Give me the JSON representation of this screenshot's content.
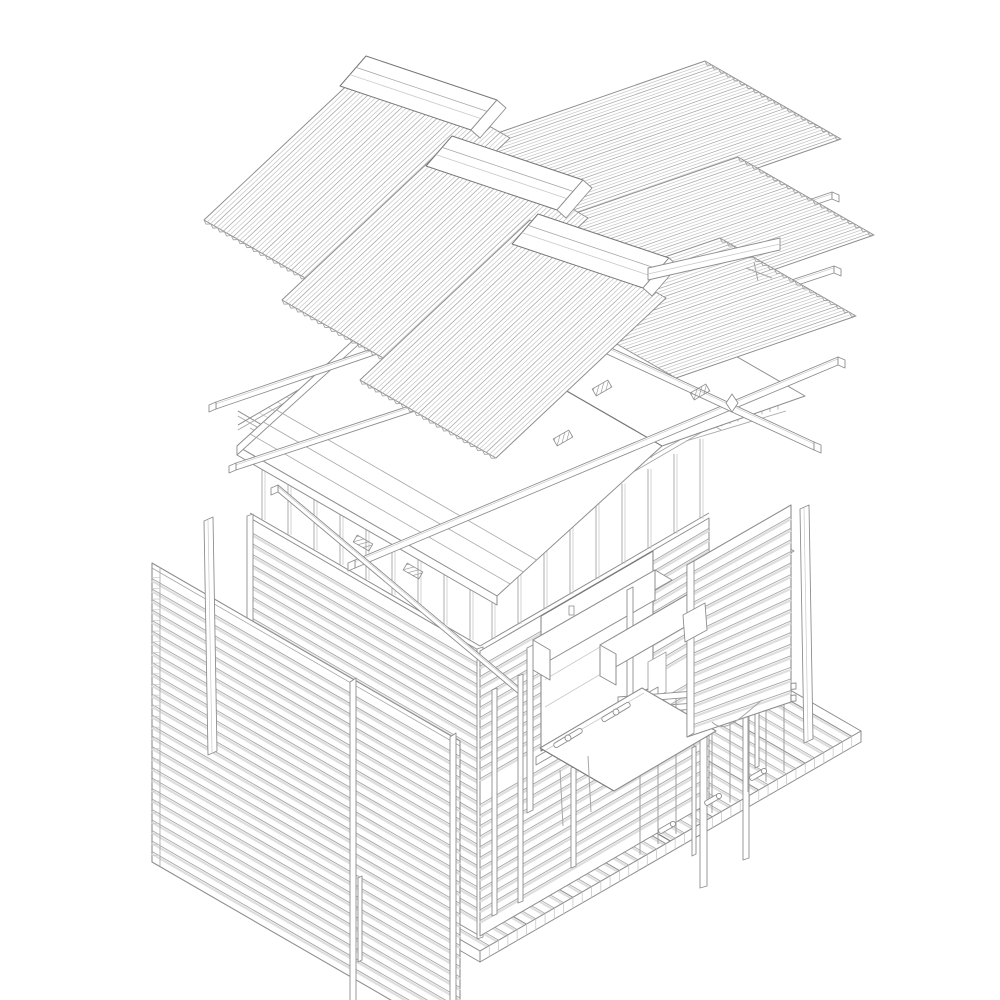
{
  "meta": {
    "title": "Exploded axonometric line drawing of a small timber kiosk pavilion",
    "drawing_type": "technical exploded axonometric, grey line work on white",
    "background": "#ffffff"
  },
  "palette": {
    "outline": "#8e8e8e",
    "line_mid": "#a6a6a6",
    "line_light": "#c9c9c9",
    "line_dark": "#787878",
    "slat_shadow": "#dedede",
    "surface": "#ffffff"
  },
  "parts": {
    "roof_sheets": "corrugated roofing sheets (exploded in three courses, two slopes)",
    "ridge_caps": "flat ridge cap boards",
    "sheathing": "roof sheathing panel with eave thickness and battens",
    "purlins": "long roof battens and diagonal braces with end cuts",
    "connector_plates": "hatched metal connector plates",
    "ceiling_battens": "ceiling batten field over wall frame",
    "frame": "wall top plates with short gable studs",
    "left_cladding_panel": "large horizontal-slat wall panel exploded to the left",
    "left_wall": "slatted left wall of kiosk",
    "front_wall": "slatted front wall with serving window",
    "window_header": "exploded lintel board over serving window",
    "counter": "fold-down serving counter leaf with hinge straps and props",
    "mullions": "thin window mullion posts standing on deck",
    "shutter_panel": "slatted roller-style shutter panel exploded to the right",
    "shutter_header": "exploded shutter head beam",
    "latch_hardware": "toggle pegs and cord latch",
    "deck": "plank deck platform with seam and edge thickness",
    "railing": "porch railing rails, posts and balusters",
    "trim_strips": "loose vertical trim strips at far left and right"
  },
  "counts": {
    "corrugated_sheets": 6,
    "ridge_caps": 3,
    "deck_planks": 41,
    "left_wall_slats": 26,
    "left_panel_slats": 28,
    "shutter_slats": 17,
    "long_battens": 4
  }
}
